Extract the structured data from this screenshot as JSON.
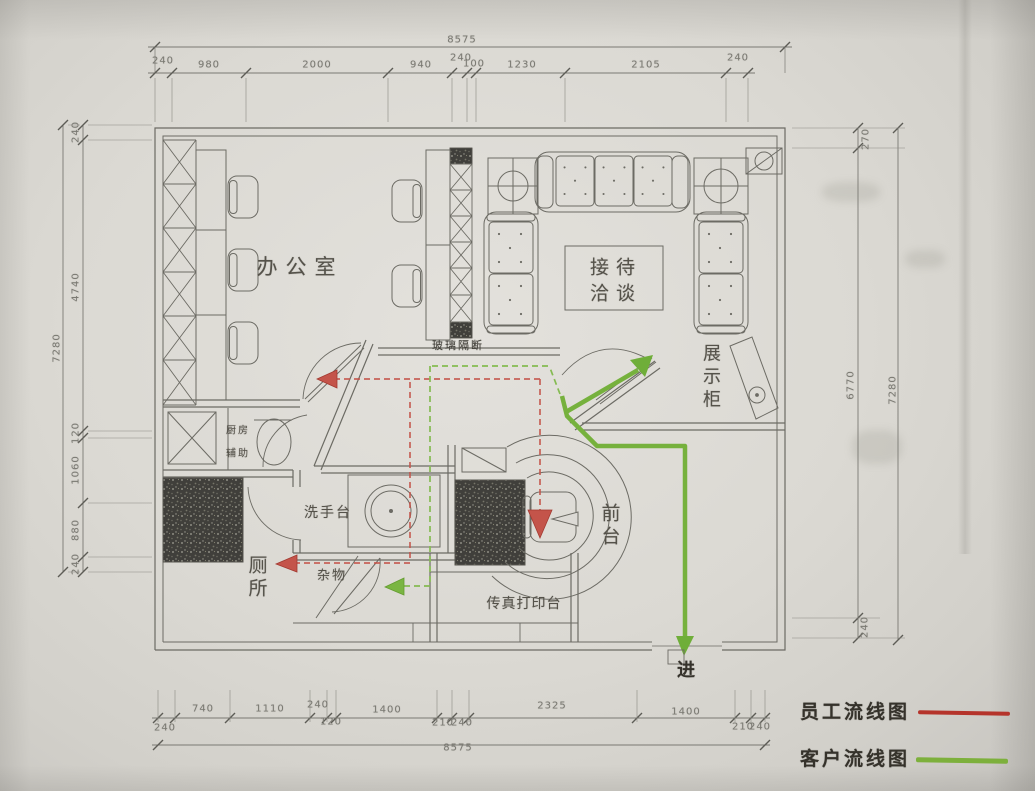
{
  "rooms": {
    "office": "办公室",
    "reception_line1": "接待",
    "reception_line2": "洽谈",
    "display_cabinet": "展示柜",
    "partition": "玻璃隔断",
    "kitchen_line1": "厨房",
    "kitchen_line2": "辅助",
    "washbasin": "洗手台",
    "toilet": "厕所",
    "sundry": "杂物",
    "front_desk": "前台",
    "fax_print": "传真打印台",
    "enter": "进"
  },
  "legend": {
    "staff": {
      "label": "员工流线图",
      "color": "#b5342b"
    },
    "customer": {
      "label": "客户流线图",
      "color": "#7db03c"
    }
  },
  "dimensions": {
    "top": {
      "total": "8575",
      "segments": [
        "240",
        "980",
        "2000",
        "940",
        "240",
        "100",
        "1230",
        "2105",
        "240"
      ]
    },
    "bottom": {
      "total": "8575",
      "segments": [
        "240",
        "740",
        "1110",
        "240",
        "120",
        "1400",
        "210",
        "240",
        "2325",
        "1400",
        "210",
        "240"
      ]
    },
    "left": {
      "total": "7280",
      "segments": [
        "240",
        "4740",
        "120",
        "1060",
        "880",
        "240"
      ]
    },
    "right": {
      "outer_total": "7280",
      "inner_total": "6770",
      "top_segment": "270",
      "bottom_segment": "240"
    }
  }
}
